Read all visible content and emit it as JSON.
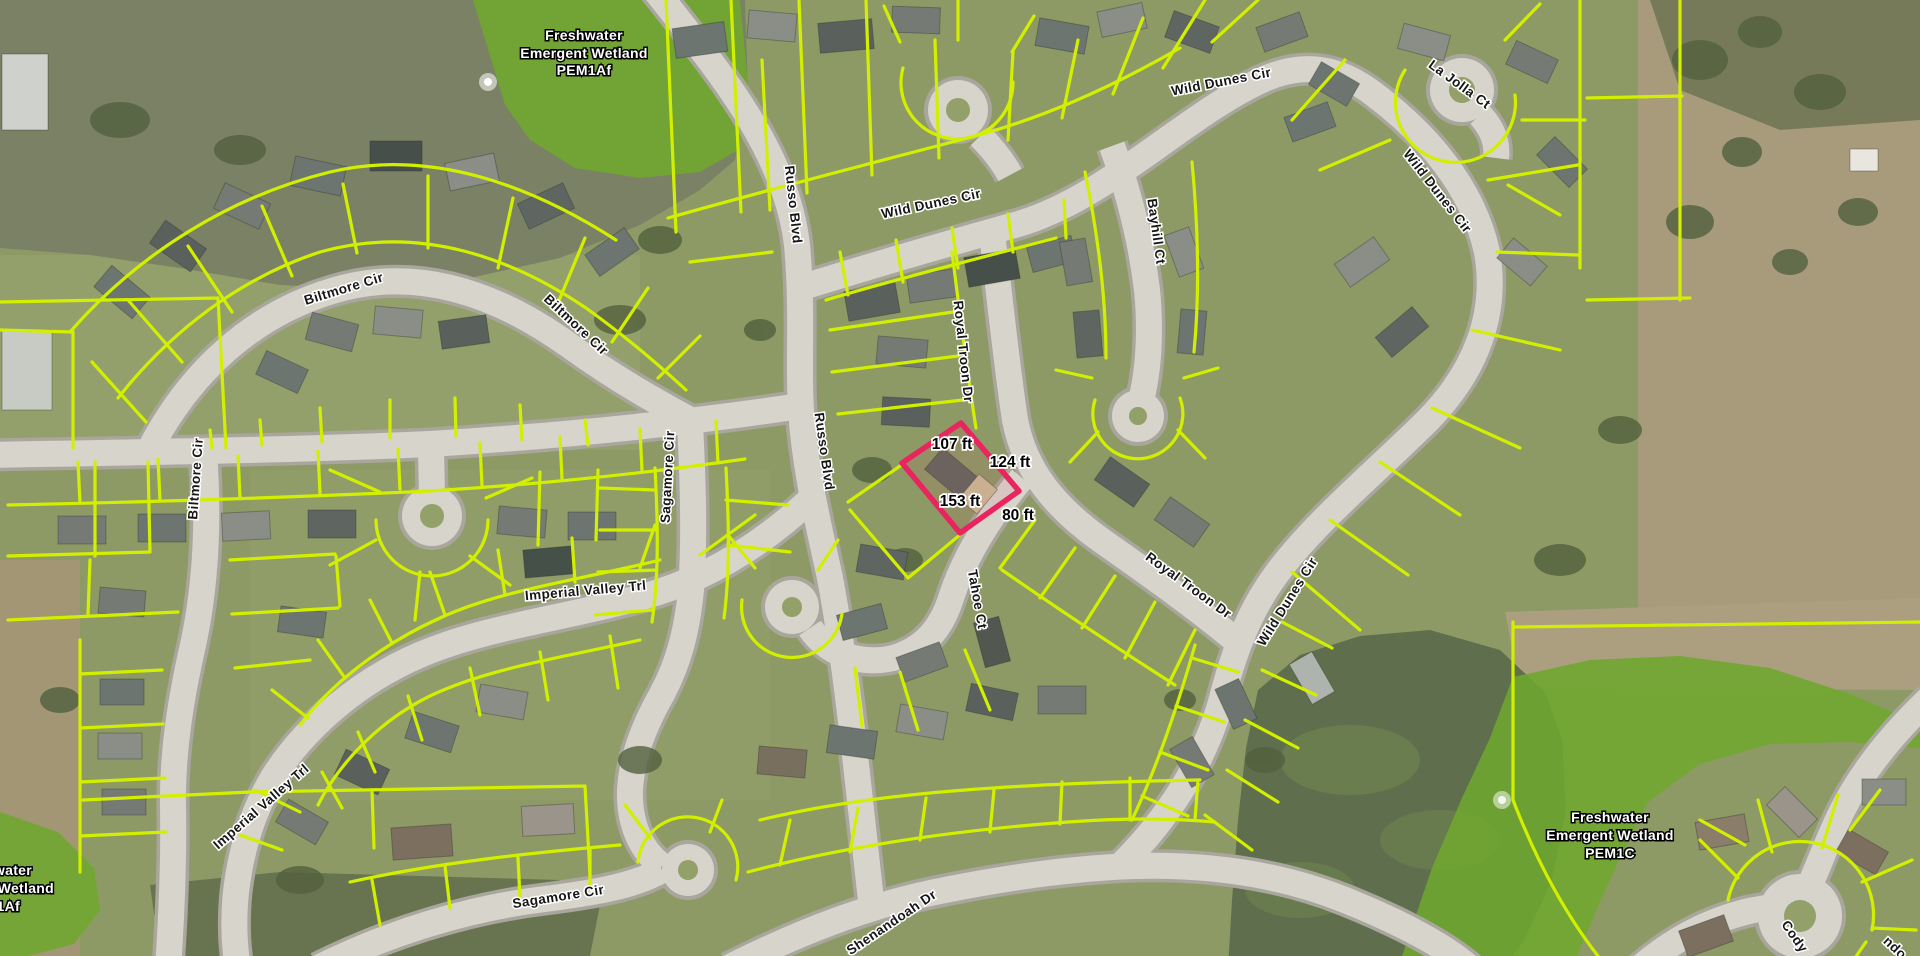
{
  "map": {
    "view": "aerial-parcel-map",
    "streets": {
      "russo_top": "Russo Blvd",
      "russo_mid": "Russo Blvd",
      "wild_dunes_top_center": "Wild Dunes Cir",
      "wild_dunes_top": "Wild Dunes Cir",
      "wild_dunes_east": "Wild Dunes Cir",
      "wild_dunes_south": "Wild Dunes Cir",
      "la_jolla": "La Jolla Ct",
      "bayhill": "Bayhill Ct",
      "royal_troon_upper": "Royal Troon Dr",
      "royal_troon_lower": "Royal Troon Dr",
      "tahoe": "Tahoe Ct",
      "biltmore_upper": "Biltmore Cir",
      "biltmore_east": "Biltmore Cir",
      "biltmore_west": "Biltmore Cir",
      "sagamore_mid": "Sagamore Cir",
      "sagamore_south": "Sagamore Cir",
      "imperial_valley_mid": "Imperial Valley Trl",
      "imperial_valley_sw": "Imperial Valley Trl",
      "shenandoah": "Shenandoah Dr",
      "cody_partial": "Cody",
      "corner_fragment": "ndo"
    },
    "wetlands": {
      "pem1af": {
        "l1": "Freshwater",
        "l2": "Emergent Wetland",
        "l3": "PEM1Af"
      },
      "pem1c": {
        "l1": "Freshwater",
        "l2": "Emergent Wetland",
        "l3": "PEM1C"
      },
      "edge_partial": {
        "l1": "water",
        "l2": "Wetland",
        "l3": "1Af"
      }
    },
    "selected_parcel": {
      "dim_top": "107 ft",
      "dim_right": "124 ft",
      "dim_left": "153 ft",
      "dim_bottom": "80 ft"
    },
    "colors": {
      "parcel_line": "#d3ef00",
      "selected_parcel_outline": "#e8255f",
      "wetland_overlay": "#6fa72f",
      "street_label_text": "#161616",
      "street_label_halo": "#ffffff",
      "wetland_label_text": "#ffffff",
      "dimension_label_text": "#000000",
      "road_surface": "#d6d4cb",
      "water_north": "#7b8165",
      "water_south": "#5f6f4d"
    }
  }
}
